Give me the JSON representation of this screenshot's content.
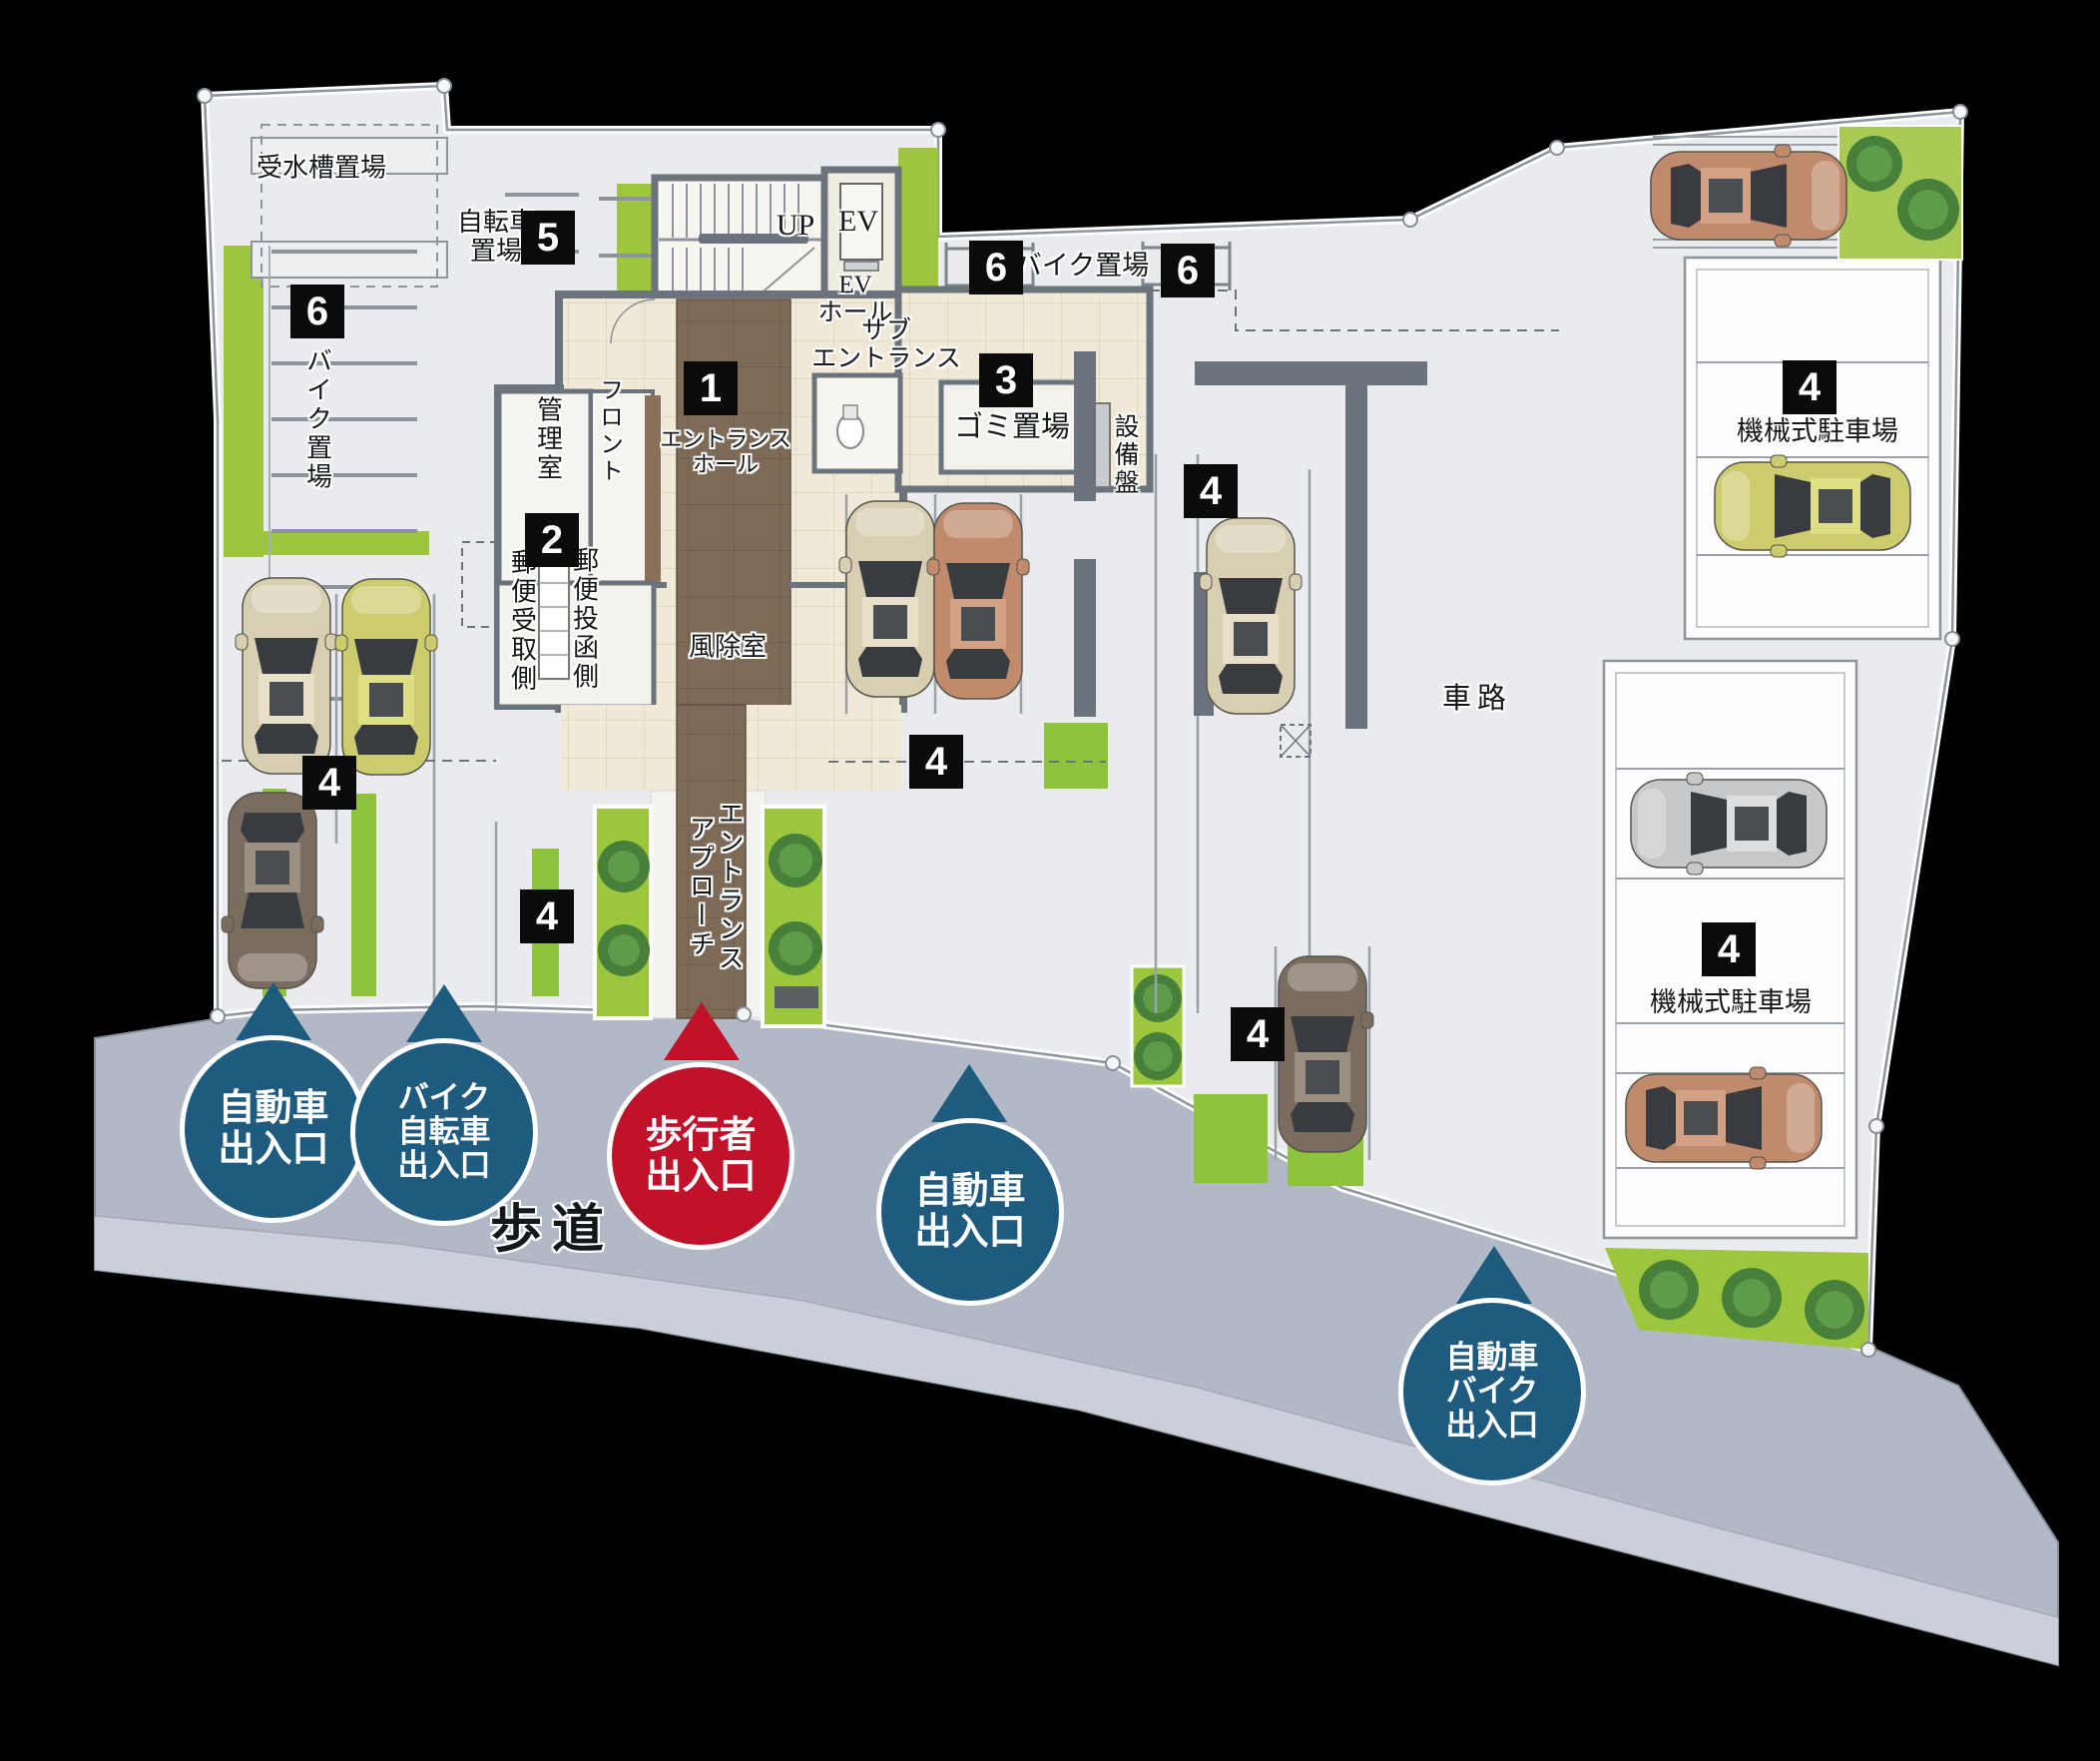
{
  "plan": {
    "labels": {
      "water_tank": "受水槽置場",
      "bicycle_line1": "自転車",
      "bicycle_line2": "置場",
      "bike_storage_left": "バイク置場",
      "bike_storage_top": "バイク置場",
      "up": "UP",
      "ev": "EV",
      "ev_hall_line1": "EV",
      "ev_hall_line2": "ホール",
      "sub_entrance_line1": "サブ",
      "sub_entrance_line2": "エントランス",
      "entrance_hall_line1": "エントランス",
      "entrance_hall_line2": "ホール",
      "manager_room": "管理室",
      "front_desk": "フロント",
      "mail_receive": "郵便受取側",
      "mail_post": "郵便投函側",
      "windbreak_room": "風除室",
      "garbage": "ゴミ置場",
      "equipment_panel": "設備盤",
      "mech_parking_top": "機械式駐車場",
      "mech_parking_bottom": "機械式駐車場",
      "driveway": "車路",
      "approach_line1": "エントランス",
      "approach_line2": "アプローチ",
      "sidewalk": "歩道"
    },
    "badges": {
      "entrance_hall": "1",
      "mail": "2",
      "garbage": "3",
      "parking_left": "4",
      "parking_bottom_left": "4",
      "parking_center": "4",
      "parking_center_right": "4",
      "parking_bottom_right": "4",
      "mech_top": "4",
      "mech_bottom": "4",
      "bicycle": "5",
      "bike_left": "6",
      "bike_top_a": "6",
      "bike_top_b": "6"
    },
    "entrances": [
      {
        "id": "car-left",
        "color": "blue",
        "lines": [
          "自動車",
          "出入口"
        ]
      },
      {
        "id": "bike-bicycle",
        "color": "blue",
        "lines": [
          "バイク",
          "自転車",
          "出入口"
        ]
      },
      {
        "id": "pedestrian",
        "color": "red",
        "lines": [
          "歩行者",
          "出入口"
        ]
      },
      {
        "id": "car-center",
        "color": "blue",
        "lines": [
          "自動車",
          "出入口"
        ]
      },
      {
        "id": "car-bike-right",
        "color": "blue",
        "lines": [
          "自動車",
          "バイク",
          "出入口"
        ]
      }
    ],
    "colors": {
      "entrance_blue": "#1e5b7f",
      "entrance_red": "#c0122b",
      "badge_bg": "#0b0b0b",
      "ground": "#e9ebee",
      "sidewalk": "#b2b9c6",
      "sidewalk_light": "#ccd2dc",
      "hedge": "#9cc63e",
      "grass": "#8fc33c",
      "tile": "#f1e9d7",
      "approach_brown": "#7d6b58",
      "wall": "#6b747c",
      "background": "#000000"
    }
  }
}
